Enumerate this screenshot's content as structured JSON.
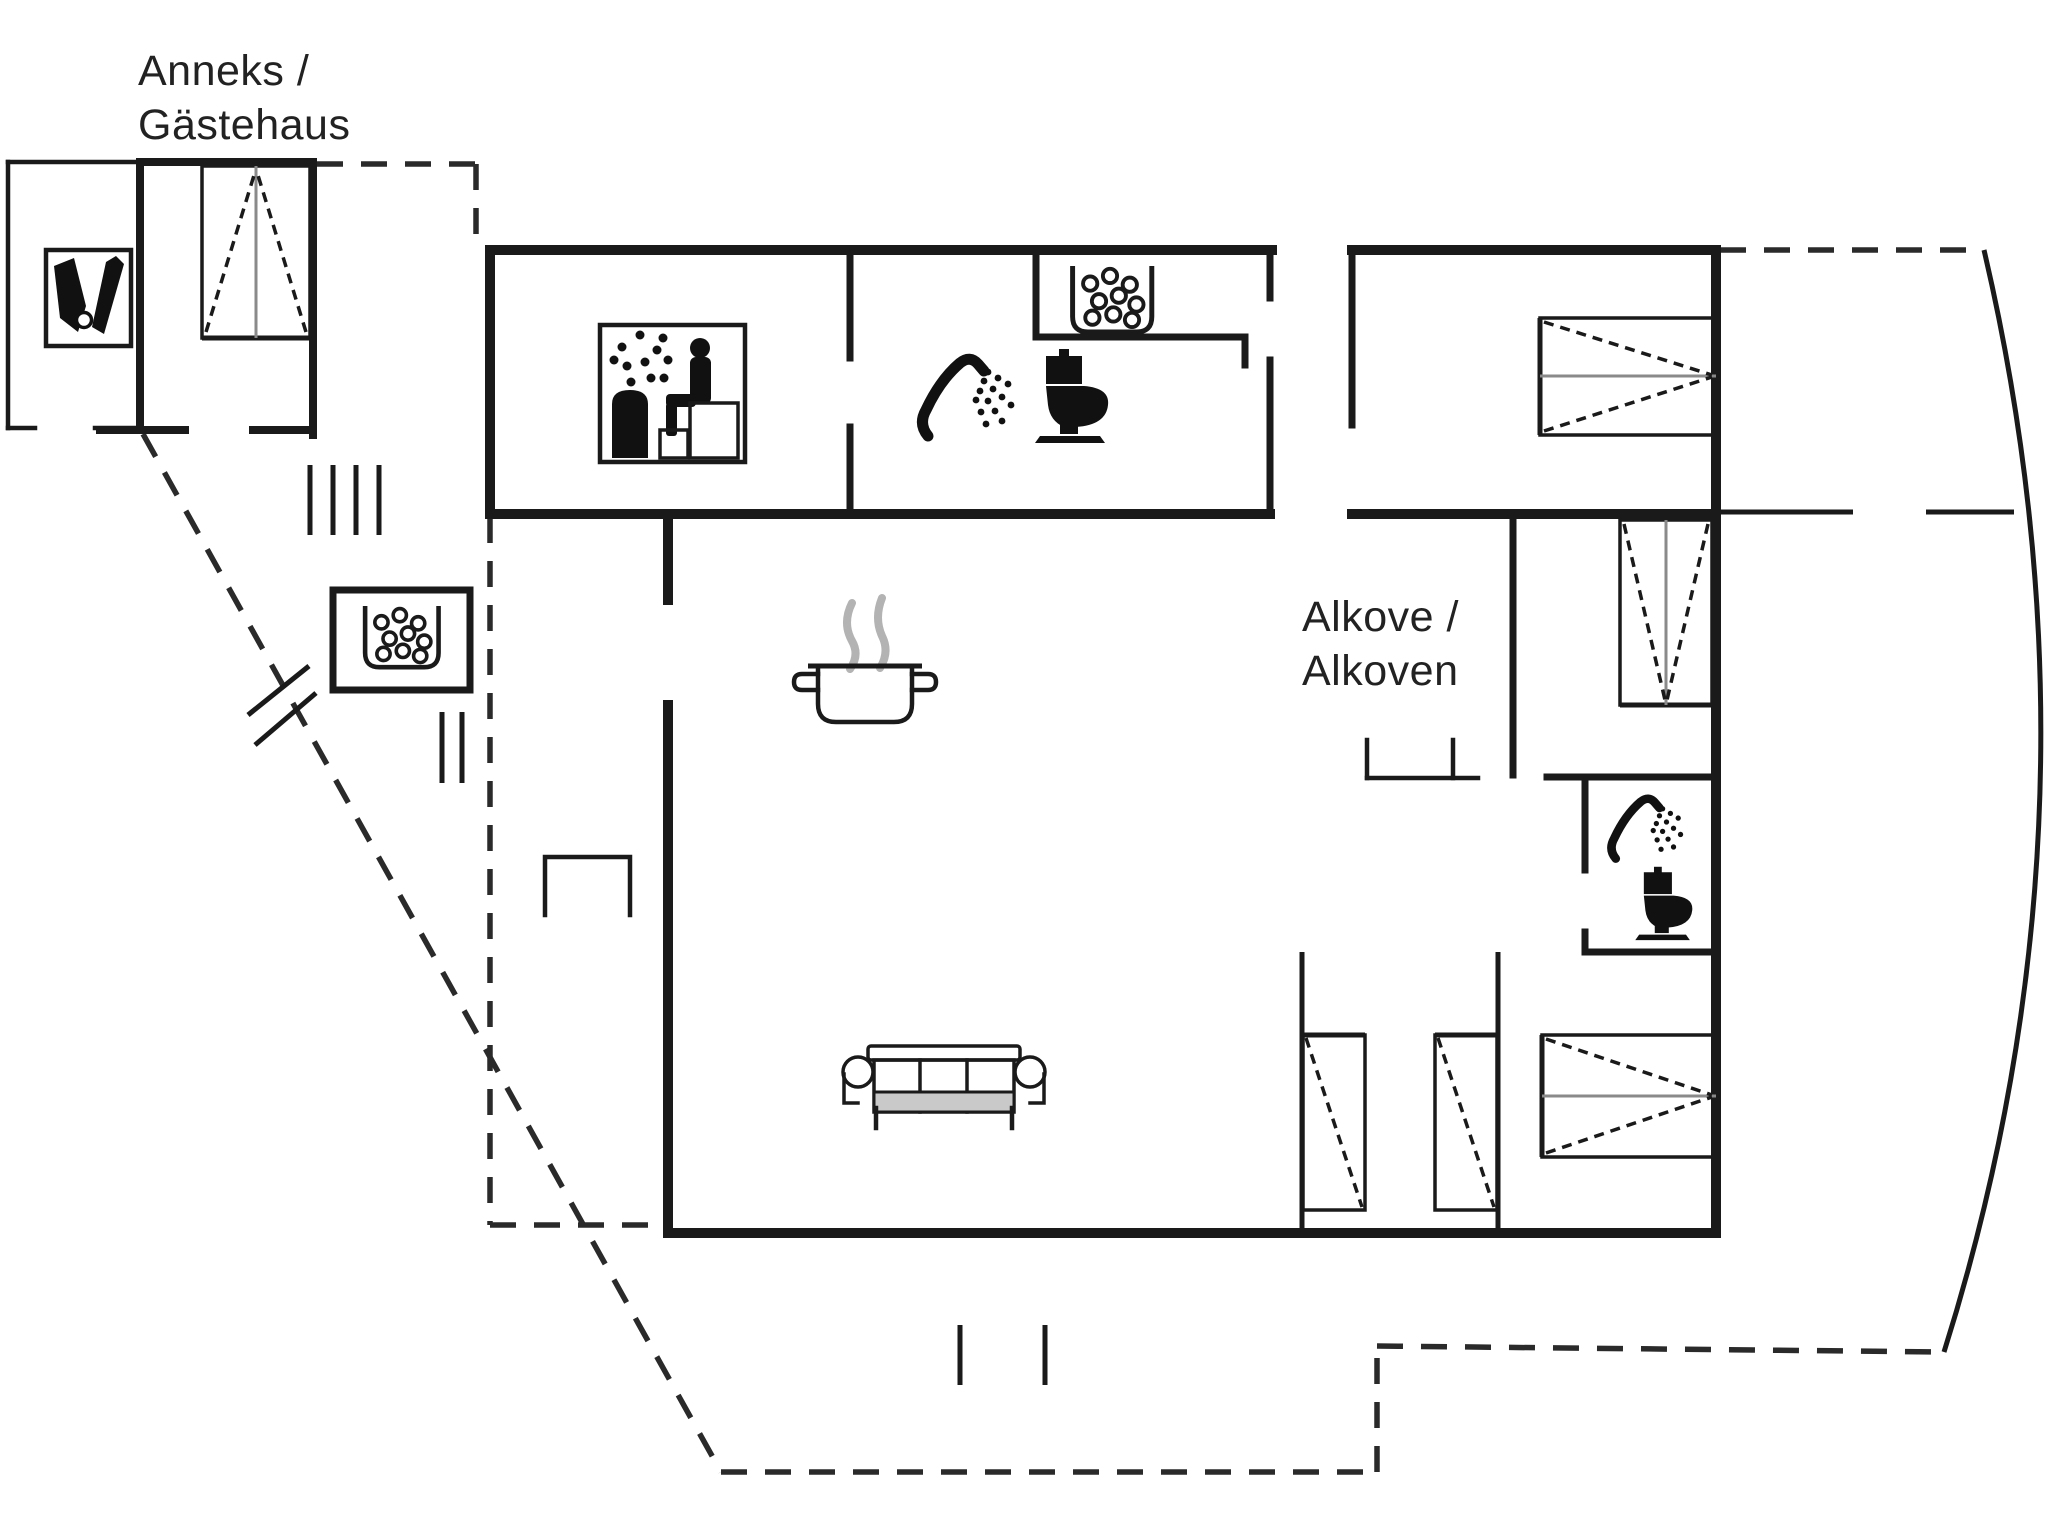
{
  "canvas": {
    "width": 2048,
    "height": 1536,
    "background": "#ffffff",
    "ink": "#1a1a1a",
    "steam_gray": "#b3b3b3",
    "cushion_gray": "#c9c9c9",
    "bed_centerline_gray": "#8a8a8a"
  },
  "labels": {
    "annex": {
      "line1": "Anneks /",
      "line2": "Gästehaus"
    },
    "alcove": {
      "line1": "Alkove /",
      "line2": "Alkoven"
    }
  },
  "features": [
    {
      "icon": "cleaning-equipment-icon",
      "meaning": "utility / storage room in annex"
    },
    {
      "icon": "double-bed-icon",
      "meaning": "double bed",
      "count": 4
    },
    {
      "icon": "single-bed-icon",
      "meaning": "single bed",
      "count": 2
    },
    {
      "icon": "sauna-icon",
      "meaning": "sauna with stove and bench"
    },
    {
      "icon": "shower-icon",
      "meaning": "shower",
      "count": 2
    },
    {
      "icon": "toilet-icon",
      "meaning": "toilet",
      "count": 2
    },
    {
      "icon": "whirlpool-icon",
      "meaning": "whirlpool / bubble bath",
      "count": 2
    },
    {
      "icon": "cooking-pot-icon",
      "meaning": "kitchen / cooking area"
    },
    {
      "icon": "sofa-icon",
      "meaning": "living room sofa"
    },
    {
      "line_style": "dashed",
      "meaning": "terrace / plot outline"
    }
  ]
}
